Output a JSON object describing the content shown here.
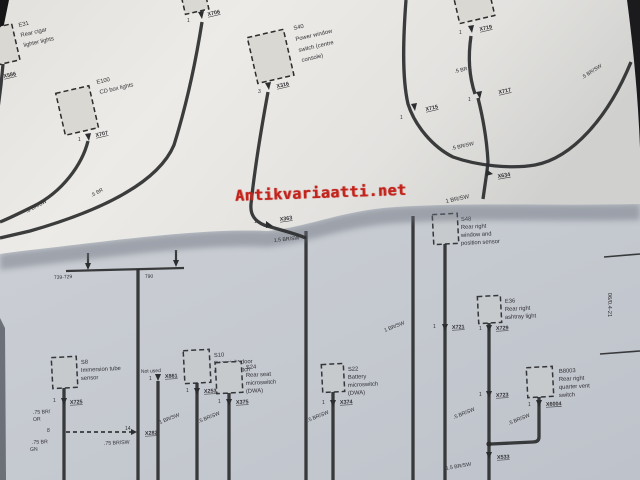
{
  "photo": {
    "watermark": "Antikvariaatti.net",
    "watermark_color": "#c3231b",
    "edge_code": "06/0.4-21"
  },
  "top_page": {
    "e31": {
      "name": "E31",
      "d1": "Rear cigar",
      "d2": "lighter lights",
      "conn": "X586"
    },
    "e100": {
      "name": "E100",
      "d1": "CD box lights",
      "pin": "1",
      "conn": "X707"
    },
    "x706": {
      "pin": "1",
      "conn": "X706"
    },
    "s40": {
      "name": "S40",
      "d1": "Power window",
      "d2": "switch (centre",
      "d3": "console)",
      "pin": "3",
      "conn": "X316"
    },
    "x719": {
      "pin": "1",
      "conn": "X719"
    },
    "x717": {
      "pin": "1",
      "conn": "X717"
    },
    "x715": {
      "pin": "1",
      "conn": "X715"
    },
    "x634": {
      "conn": "X634"
    },
    "x363": {
      "pin": "1",
      "conn": "X363",
      "wire": "1.5 BR/SW"
    },
    "wires": {
      "br1": ".5 BR",
      "brsw1": ".5 BR/SW",
      "brsw2": ".5 BR/SW",
      "br2": ".5 BR",
      "brsw3": ".5 BR/SW",
      "tiny": "1 BR/SW"
    }
  },
  "bottom_page": {
    "bracket": {
      "left": "739-729",
      "right": "790"
    },
    "s8": {
      "name": "S8",
      "d1": "Immersion tube",
      "d2": "sensor",
      "pin": "1",
      "conn": "X725",
      "pin2": "8",
      "w1": ".75 BR/",
      "w1c": "OR",
      "w2": ".75 BR",
      "w2c": "GN",
      "w3": ".75 BR/SW"
    },
    "x282": {
      "pin": "14",
      "conn": "X282"
    },
    "x861": {
      "note": "Not used",
      "pin": "1",
      "conn": "X861",
      "wire": "1 BR/SW"
    },
    "s10": {
      "name": "S10",
      "d1": "Rear right door",
      "d2": "contact switch",
      "pin": "1",
      "conn": "X253",
      "wire": ".5 BR/SW"
    },
    "s24": {
      "name": "S24",
      "d1": "Rear seat",
      "d2": "microswitch",
      "d3": "(DWA)",
      "pin": "1",
      "conn": "X375"
    },
    "v6": {
      "wire": ".5 BR/SW"
    },
    "s22": {
      "name": "S22",
      "d1": "Battery",
      "d2": "microswitch",
      "d3": "(DWA)",
      "pin": "1",
      "conn": "X374"
    },
    "v7": {
      "wire": "1 BR/SW"
    },
    "s48": {
      "name": "S48",
      "d1": "Rear right",
      "d2": "window and",
      "d3": "position sensor",
      "pin": "1",
      "conn": "X721"
    },
    "e36": {
      "name": "E36",
      "d1": "Rear right",
      "d2": "ashtray light",
      "pin": "1",
      "conn": "X729"
    },
    "x723": {
      "pin": "1",
      "conn": "X723",
      "wire": ".5 BR/SW"
    },
    "b8003": {
      "name": "B8003",
      "d1": "Rear right",
      "d2": "quarter vent",
      "d3": "switch",
      "pin": "1",
      "conn": "X6004",
      "wire": ".5 BR/SW"
    },
    "x533": {
      "conn": "X533",
      "wire": "1.5 BR/SW"
    }
  }
}
